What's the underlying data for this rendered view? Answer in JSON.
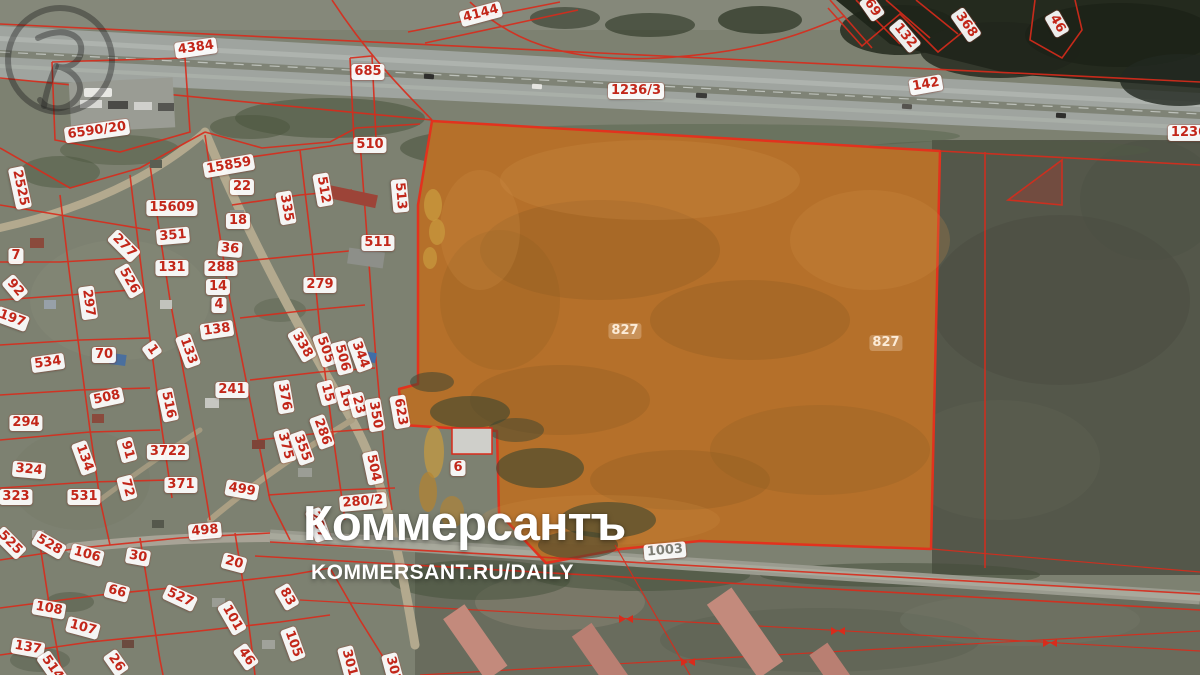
{
  "watermark": {
    "wordmark": "Коммерсантъ",
    "site": "KOMMERSANT.RU/DAILY"
  },
  "map": {
    "type": "cadastral-satellite",
    "colors": {
      "parcel_boundary": "#d92b1b",
      "highlight_fill": "#b5702a",
      "label_text": "#c22619",
      "label_bg": "#ffffff",
      "watermark_text": "#ffffff"
    },
    "highlighted_parcel_ids": [
      "827"
    ],
    "labels": [
      {
        "text": "4384",
        "x": 196,
        "y": 48,
        "rot": -8
      },
      {
        "text": "685",
        "x": 368,
        "y": 72,
        "rot": 0
      },
      {
        "text": "4144",
        "x": 481,
        "y": 14,
        "rot": -15
      },
      {
        "text": "1236/3",
        "x": 636,
        "y": 91,
        "rot": 0
      },
      {
        "text": "142",
        "x": 926,
        "y": 85,
        "rot": -10
      },
      {
        "text": "69",
        "x": 872,
        "y": 8,
        "rot": 55
      },
      {
        "text": "132",
        "x": 905,
        "y": 36,
        "rot": 50
      },
      {
        "text": "368",
        "x": 966,
        "y": 25,
        "rot": 55
      },
      {
        "text": "46",
        "x": 1057,
        "y": 24,
        "rot": 60
      },
      {
        "text": "1236",
        "x": 1189,
        "y": 133,
        "rot": 0
      },
      {
        "text": "6590/20",
        "x": 97,
        "y": 131,
        "rot": -8
      },
      {
        "text": "2525",
        "x": 20,
        "y": 188,
        "rot": 78
      },
      {
        "text": "15859",
        "x": 229,
        "y": 166,
        "rot": -10
      },
      {
        "text": "22",
        "x": 242,
        "y": 187,
        "rot": 0
      },
      {
        "text": "510",
        "x": 370,
        "y": 145,
        "rot": 0
      },
      {
        "text": "15609",
        "x": 172,
        "y": 208,
        "rot": 0
      },
      {
        "text": "512",
        "x": 323,
        "y": 190,
        "rot": 80
      },
      {
        "text": "335",
        "x": 286,
        "y": 208,
        "rot": 80
      },
      {
        "text": "18",
        "x": 238,
        "y": 221,
        "rot": 0
      },
      {
        "text": "513",
        "x": 400,
        "y": 196,
        "rot": 85
      },
      {
        "text": "511",
        "x": 378,
        "y": 243,
        "rot": 0
      },
      {
        "text": "351",
        "x": 173,
        "y": 236,
        "rot": -5
      },
      {
        "text": "36",
        "x": 230,
        "y": 249,
        "rot": 5
      },
      {
        "text": "277",
        "x": 124,
        "y": 246,
        "rot": 45
      },
      {
        "text": "7",
        "x": 16,
        "y": 256,
        "rot": 0
      },
      {
        "text": "131",
        "x": 172,
        "y": 268,
        "rot": 0
      },
      {
        "text": "288",
        "x": 221,
        "y": 268,
        "rot": 0
      },
      {
        "text": "526",
        "x": 129,
        "y": 281,
        "rot": 60
      },
      {
        "text": "14",
        "x": 218,
        "y": 287,
        "rot": 0
      },
      {
        "text": "92",
        "x": 15,
        "y": 288,
        "rot": 50
      },
      {
        "text": "279",
        "x": 320,
        "y": 285,
        "rot": 0
      },
      {
        "text": "297",
        "x": 88,
        "y": 303,
        "rot": 82
      },
      {
        "text": "4",
        "x": 219,
        "y": 305,
        "rot": 0
      },
      {
        "text": "197",
        "x": 12,
        "y": 319,
        "rot": 20
      },
      {
        "text": "138",
        "x": 217,
        "y": 330,
        "rot": -8
      },
      {
        "text": "133",
        "x": 188,
        "y": 351,
        "rot": 70
      },
      {
        "text": "1",
        "x": 152,
        "y": 350,
        "rot": 55
      },
      {
        "text": "534",
        "x": 48,
        "y": 363,
        "rot": -8
      },
      {
        "text": "70",
        "x": 104,
        "y": 355,
        "rot": 0
      },
      {
        "text": "508",
        "x": 107,
        "y": 398,
        "rot": -12
      },
      {
        "text": "516",
        "x": 168,
        "y": 405,
        "rot": 78
      },
      {
        "text": "241",
        "x": 232,
        "y": 390,
        "rot": 0
      },
      {
        "text": "376",
        "x": 284,
        "y": 397,
        "rot": 80
      },
      {
        "text": "294",
        "x": 26,
        "y": 423,
        "rot": 0
      },
      {
        "text": "91",
        "x": 127,
        "y": 450,
        "rot": 75
      },
      {
        "text": "3722",
        "x": 168,
        "y": 452,
        "rot": 0
      },
      {
        "text": "134",
        "x": 84,
        "y": 458,
        "rot": 70
      },
      {
        "text": "375",
        "x": 285,
        "y": 446,
        "rot": 75
      },
      {
        "text": "324",
        "x": 29,
        "y": 470,
        "rot": 5
      },
      {
        "text": "371",
        "x": 181,
        "y": 485,
        "rot": 0
      },
      {
        "text": "499",
        "x": 242,
        "y": 490,
        "rot": 10
      },
      {
        "text": "72",
        "x": 127,
        "y": 488,
        "rot": 75
      },
      {
        "text": "323",
        "x": 16,
        "y": 497,
        "rot": 0
      },
      {
        "text": "531",
        "x": 84,
        "y": 497,
        "rot": 0
      },
      {
        "text": "498",
        "x": 205,
        "y": 531,
        "rot": -5
      },
      {
        "text": "338",
        "x": 302,
        "y": 345,
        "rot": 60
      },
      {
        "text": "505",
        "x": 325,
        "y": 350,
        "rot": 70
      },
      {
        "text": "506",
        "x": 342,
        "y": 358,
        "rot": 75
      },
      {
        "text": "344",
        "x": 360,
        "y": 355,
        "rot": 70
      },
      {
        "text": "15",
        "x": 327,
        "y": 393,
        "rot": 75
      },
      {
        "text": "16",
        "x": 345,
        "y": 398,
        "rot": 75
      },
      {
        "text": "23",
        "x": 358,
        "y": 405,
        "rot": 75
      },
      {
        "text": "350",
        "x": 375,
        "y": 415,
        "rot": 80
      },
      {
        "text": "623",
        "x": 400,
        "y": 412,
        "rot": 80
      },
      {
        "text": "286",
        "x": 322,
        "y": 432,
        "rot": 70
      },
      {
        "text": "355",
        "x": 302,
        "y": 448,
        "rot": 70
      },
      {
        "text": "504",
        "x": 373,
        "y": 468,
        "rot": 78
      },
      {
        "text": "287",
        "x": 318,
        "y": 525,
        "rot": 70
      },
      {
        "text": "280/2",
        "x": 363,
        "y": 502,
        "rot": -5
      },
      {
        "text": "6",
        "x": 458,
        "y": 468,
        "rot": 0
      },
      {
        "text": "827",
        "x": 625,
        "y": 331,
        "rot": 0,
        "kind": "faint"
      },
      {
        "text": "827",
        "x": 886,
        "y": 343,
        "rot": 0,
        "kind": "faint"
      },
      {
        "text": "1003",
        "x": 665,
        "y": 551,
        "rot": -5,
        "kind": "roadgrey"
      },
      {
        "text": "525",
        "x": 10,
        "y": 543,
        "rot": 45
      },
      {
        "text": "528",
        "x": 49,
        "y": 545,
        "rot": 30
      },
      {
        "text": "106",
        "x": 87,
        "y": 555,
        "rot": 15
      },
      {
        "text": "30",
        "x": 138,
        "y": 557,
        "rot": 10
      },
      {
        "text": "20",
        "x": 234,
        "y": 563,
        "rot": 15
      },
      {
        "text": "66",
        "x": 117,
        "y": 592,
        "rot": 15
      },
      {
        "text": "527",
        "x": 180,
        "y": 598,
        "rot": 25
      },
      {
        "text": "83",
        "x": 287,
        "y": 597,
        "rot": 60
      },
      {
        "text": "108",
        "x": 49,
        "y": 609,
        "rot": 10
      },
      {
        "text": "101",
        "x": 232,
        "y": 618,
        "rot": 60
      },
      {
        "text": "107",
        "x": 83,
        "y": 628,
        "rot": 15
      },
      {
        "text": "137",
        "x": 28,
        "y": 648,
        "rot": 10
      },
      {
        "text": "105",
        "x": 293,
        "y": 644,
        "rot": 70
      },
      {
        "text": "46",
        "x": 246,
        "y": 657,
        "rot": 55
      },
      {
        "text": "26",
        "x": 116,
        "y": 663,
        "rot": 55
      },
      {
        "text": "514",
        "x": 52,
        "y": 668,
        "rot": 55
      },
      {
        "text": "301",
        "x": 349,
        "y": 663,
        "rot": 75
      },
      {
        "text": "302",
        "x": 393,
        "y": 670,
        "rot": 75
      }
    ]
  }
}
